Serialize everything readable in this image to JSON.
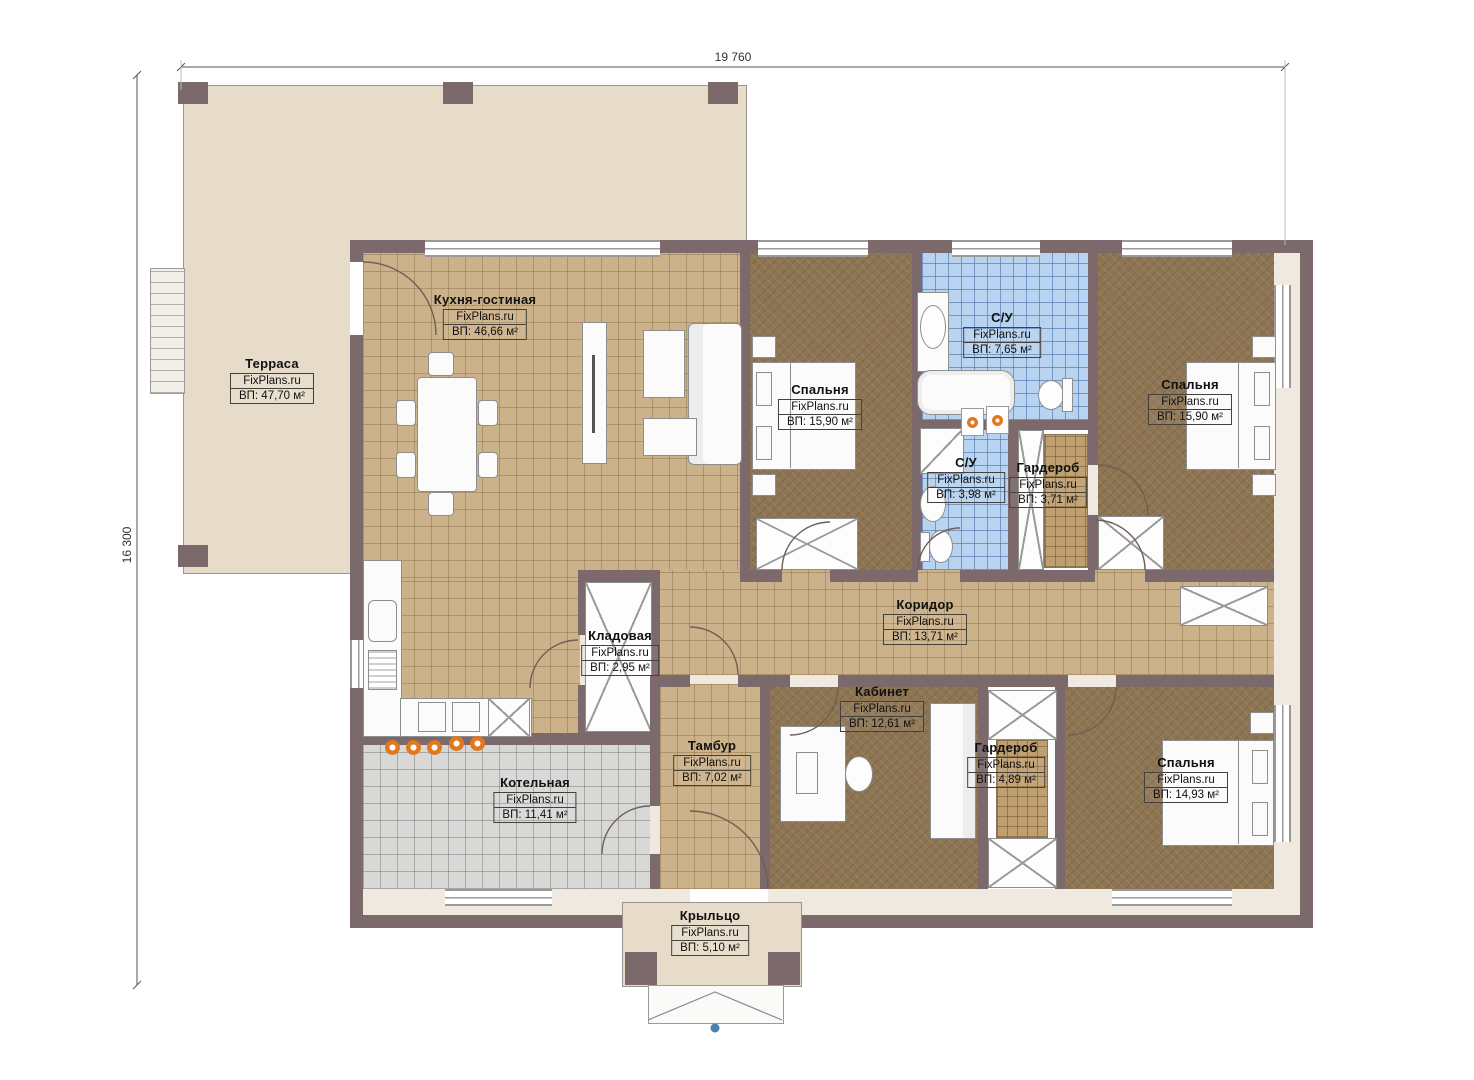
{
  "meta": {
    "brand": "FixPlans.ru"
  },
  "dimensions": {
    "width_label": "19 760",
    "height_label": "16 300"
  },
  "colors": {
    "wall": "#7b696b",
    "floor_tile_tan": "#ccb28a",
    "floor_bedroom_brown": "#8d7452",
    "floor_bath_blue": "#b7d3ef",
    "floor_boiler_gray": "#d8d8d6",
    "terrace_beige": "#e7dcca",
    "burner_orange": "#e07820",
    "marker_blue": "#4a7fb5"
  },
  "rooms": {
    "terrace": {
      "name": "Терраса",
      "area": "ВП: 47,70 м²"
    },
    "kitchen": {
      "name": "Кухня-гостиная",
      "area": "ВП: 46,66 м²"
    },
    "bedroom1": {
      "name": "Спальня",
      "area": "ВП: 15,90 м²"
    },
    "bath1": {
      "name": "С/У",
      "area": "ВП: 7,65 м²"
    },
    "bedroom2": {
      "name": "Спальня",
      "area": "ВП: 15,90 м²"
    },
    "bath2": {
      "name": "С/У",
      "area": "ВП: 3,98 м²"
    },
    "wardrobe1": {
      "name": "Гардероб",
      "area": "ВП: 3,71 м²"
    },
    "corridor": {
      "name": "Коридор",
      "area": "ВП: 13,71 м²"
    },
    "pantry": {
      "name": "Кладовая",
      "area": "ВП: 2,95 м²"
    },
    "office": {
      "name": "Кабинет",
      "area": "ВП: 12,61 м²"
    },
    "vestibule": {
      "name": "Тамбур",
      "area": "ВП: 7,02 м²"
    },
    "wardrobe2": {
      "name": "Гардероб",
      "area": "ВП: 4,89 м²"
    },
    "bedroom3": {
      "name": "Спальня",
      "area": "ВП: 14,93 м²"
    },
    "boiler": {
      "name": "Котельная",
      "area": "ВП: 11,41 м²"
    },
    "porch": {
      "name": "Крыльцо",
      "area": "ВП: 5,10 м²"
    }
  }
}
